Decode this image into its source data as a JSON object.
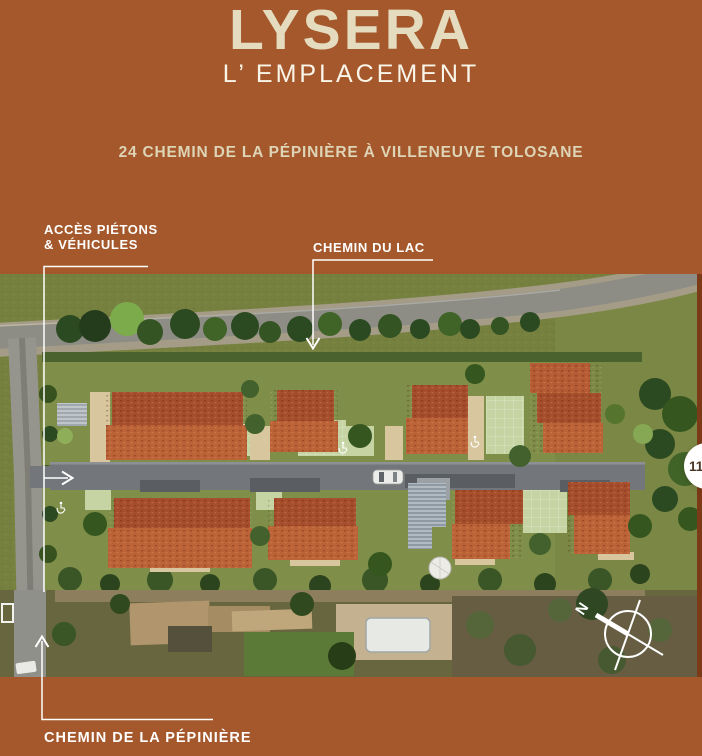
{
  "colors": {
    "background": "#A4582B",
    "title_cream": "#E5DBBE",
    "subtitle_white": "#F9F5E9",
    "address_cream": "#DED4B6",
    "label_white": "#FFFFFF",
    "right_edge_strip": "#7C3A17",
    "badge_bg": "#FFFFFF",
    "badge_text": "#4A3423",
    "roof_red": "#B65C34",
    "lawn_green": "#7F8E49",
    "road_gray": "#73767A"
  },
  "header": {
    "title": "LYSERA",
    "subtitle": "L’ EMPLACEMENT",
    "address": "24 CHEMIN DE LA PÉPINIÈRE À VILLENEUVE TOLOSANE"
  },
  "callouts": {
    "access": {
      "line1": "ACCÈS PIÉTONS",
      "line2": "& VÉHICULES"
    },
    "chemin_du_lac": "CHEMIN DU LAC",
    "chemin_de_la_pepiniere": "CHEMIN DE LA PÉPINIÈRE"
  },
  "compass": {
    "north": "N"
  },
  "badge": {
    "number": "11"
  }
}
